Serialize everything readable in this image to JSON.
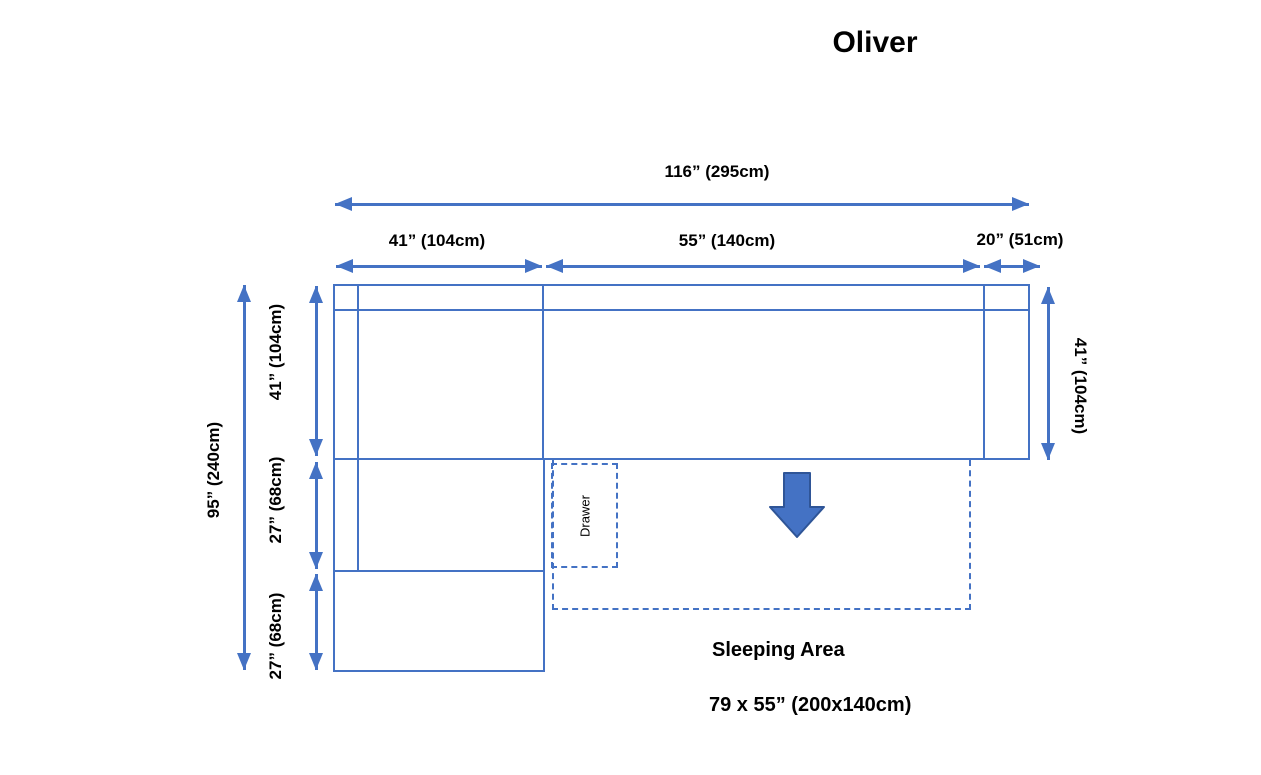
{
  "title": "Oliver",
  "colors": {
    "line": "#4472C4",
    "arrow_fill": "#4472C4",
    "arrow_outline": "#2F5597",
    "text": "#000000",
    "background": "#FFFFFF"
  },
  "dimensions": {
    "top_total": "116” (295cm)",
    "top_left": "41” (104cm)",
    "top_middle": "55” (140cm)",
    "top_right": "20” (51cm)",
    "left_total": "95” (240cm)",
    "left_upper": "41” (104cm)",
    "left_middle": "27” (68cm)",
    "left_lower": "27” (68cm)",
    "right_side": "41” (104cm)"
  },
  "labels": {
    "drawer": "Drawer",
    "sleeping_area_title": "Sleeping Area",
    "sleeping_area_size": "79 x 55” (200x140cm)"
  }
}
